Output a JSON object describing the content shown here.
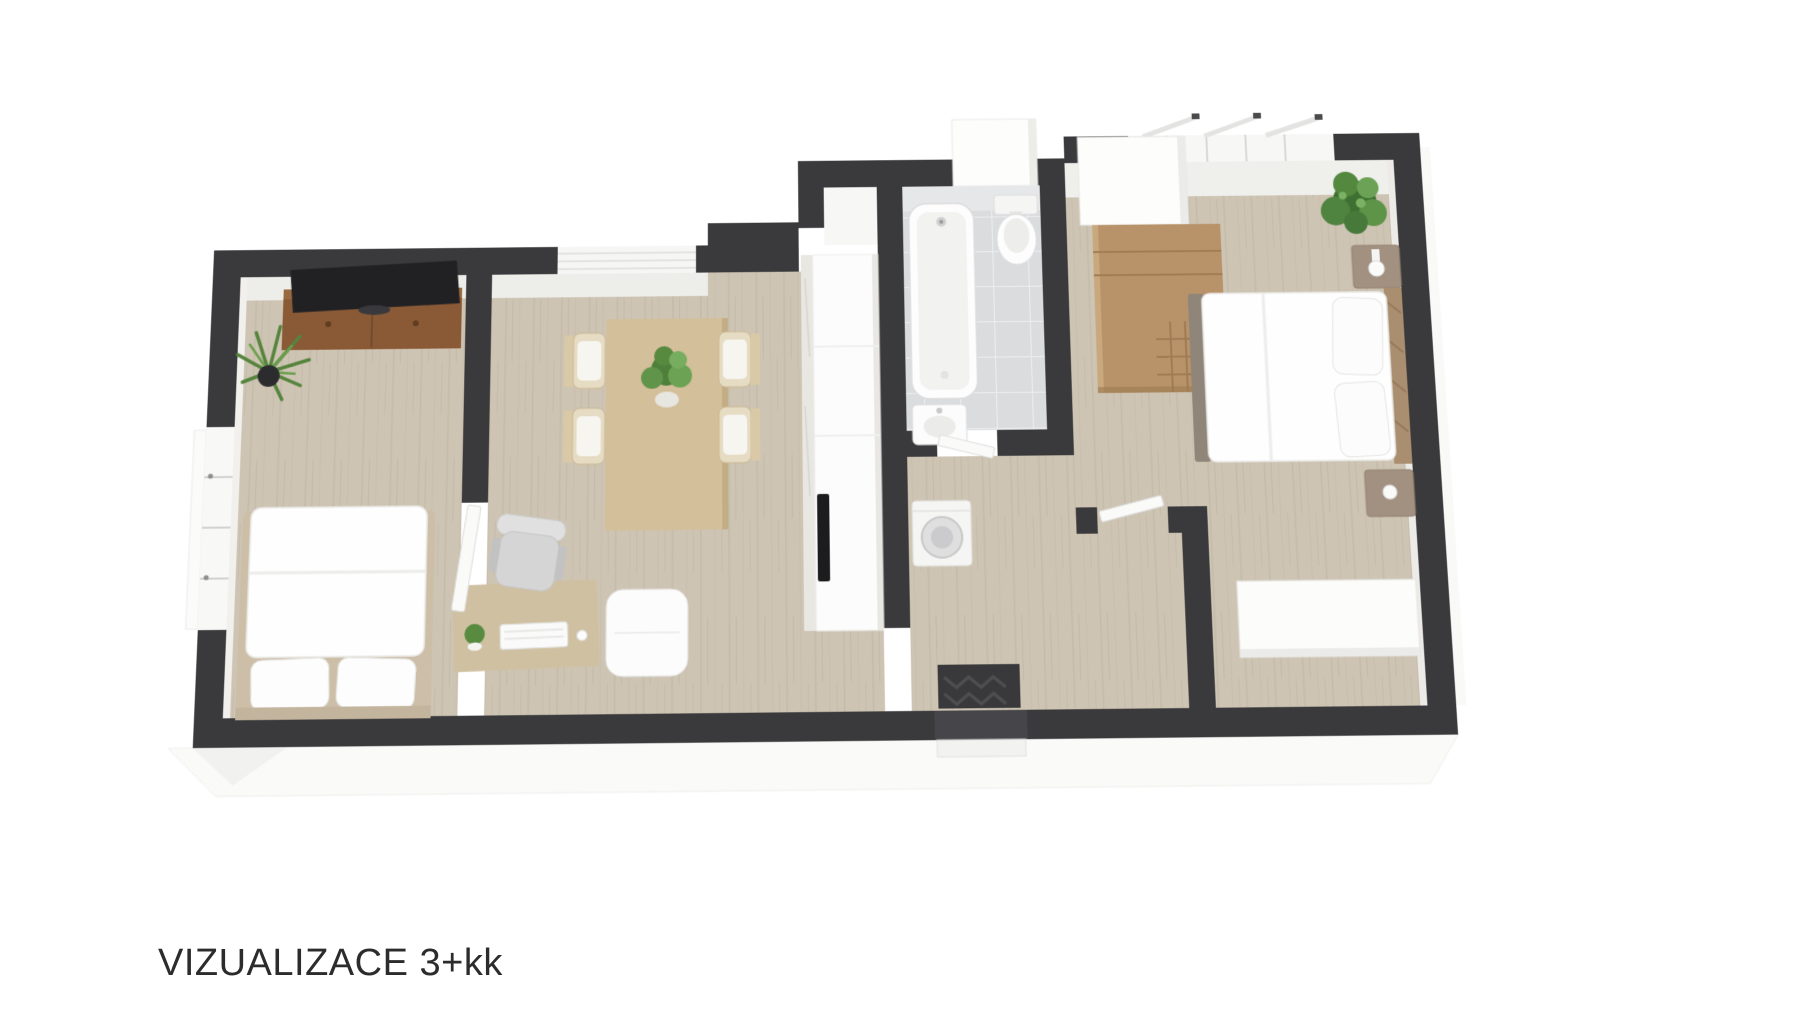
{
  "caption": {
    "text": "VIZUALIZACE 3+kk"
  },
  "floorplan": {
    "kind": "3D floor plan visualization, top-down perspective render",
    "rooms": [
      {
        "name": "bedroom-left",
        "items": [
          "double-bed",
          "pillows",
          "tv-sideboard",
          "tv",
          "potted-plant",
          "window-band"
        ]
      },
      {
        "name": "living-dining",
        "items": [
          "dining-table",
          "dining-chairs-4",
          "table-plant",
          "desk",
          "keyboard",
          "mouse",
          "desk-plant",
          "office-chair",
          "pouf",
          "kitchen-counter",
          "cooktop",
          "window-band"
        ]
      },
      {
        "name": "bathroom",
        "items": [
          "bathtub",
          "toilet",
          "washbasin",
          "washing-machine"
        ]
      },
      {
        "name": "hallway",
        "items": [
          "entrance-opening",
          "doormat",
          "interior-door-leaves"
        ]
      },
      {
        "name": "bedroom-right",
        "items": [
          "double-bed",
          "pillows",
          "wood-headboard",
          "nightstand-with-lamp",
          "second-nightstand",
          "open-wardrobe-shelf",
          "tall-white-cabinet",
          "white-dresser",
          "large-plant",
          "windows-with-open-sashes"
        ]
      }
    ],
    "colors": {
      "wall": "#3a3a3c",
      "floor_wood": "#cec4b3",
      "floor_tile": "#dadcde",
      "wood_furniture": "#b8936a",
      "sideboard": "#8a5a36",
      "accent_plant": "#55843c",
      "background": "#ffffff"
    }
  }
}
